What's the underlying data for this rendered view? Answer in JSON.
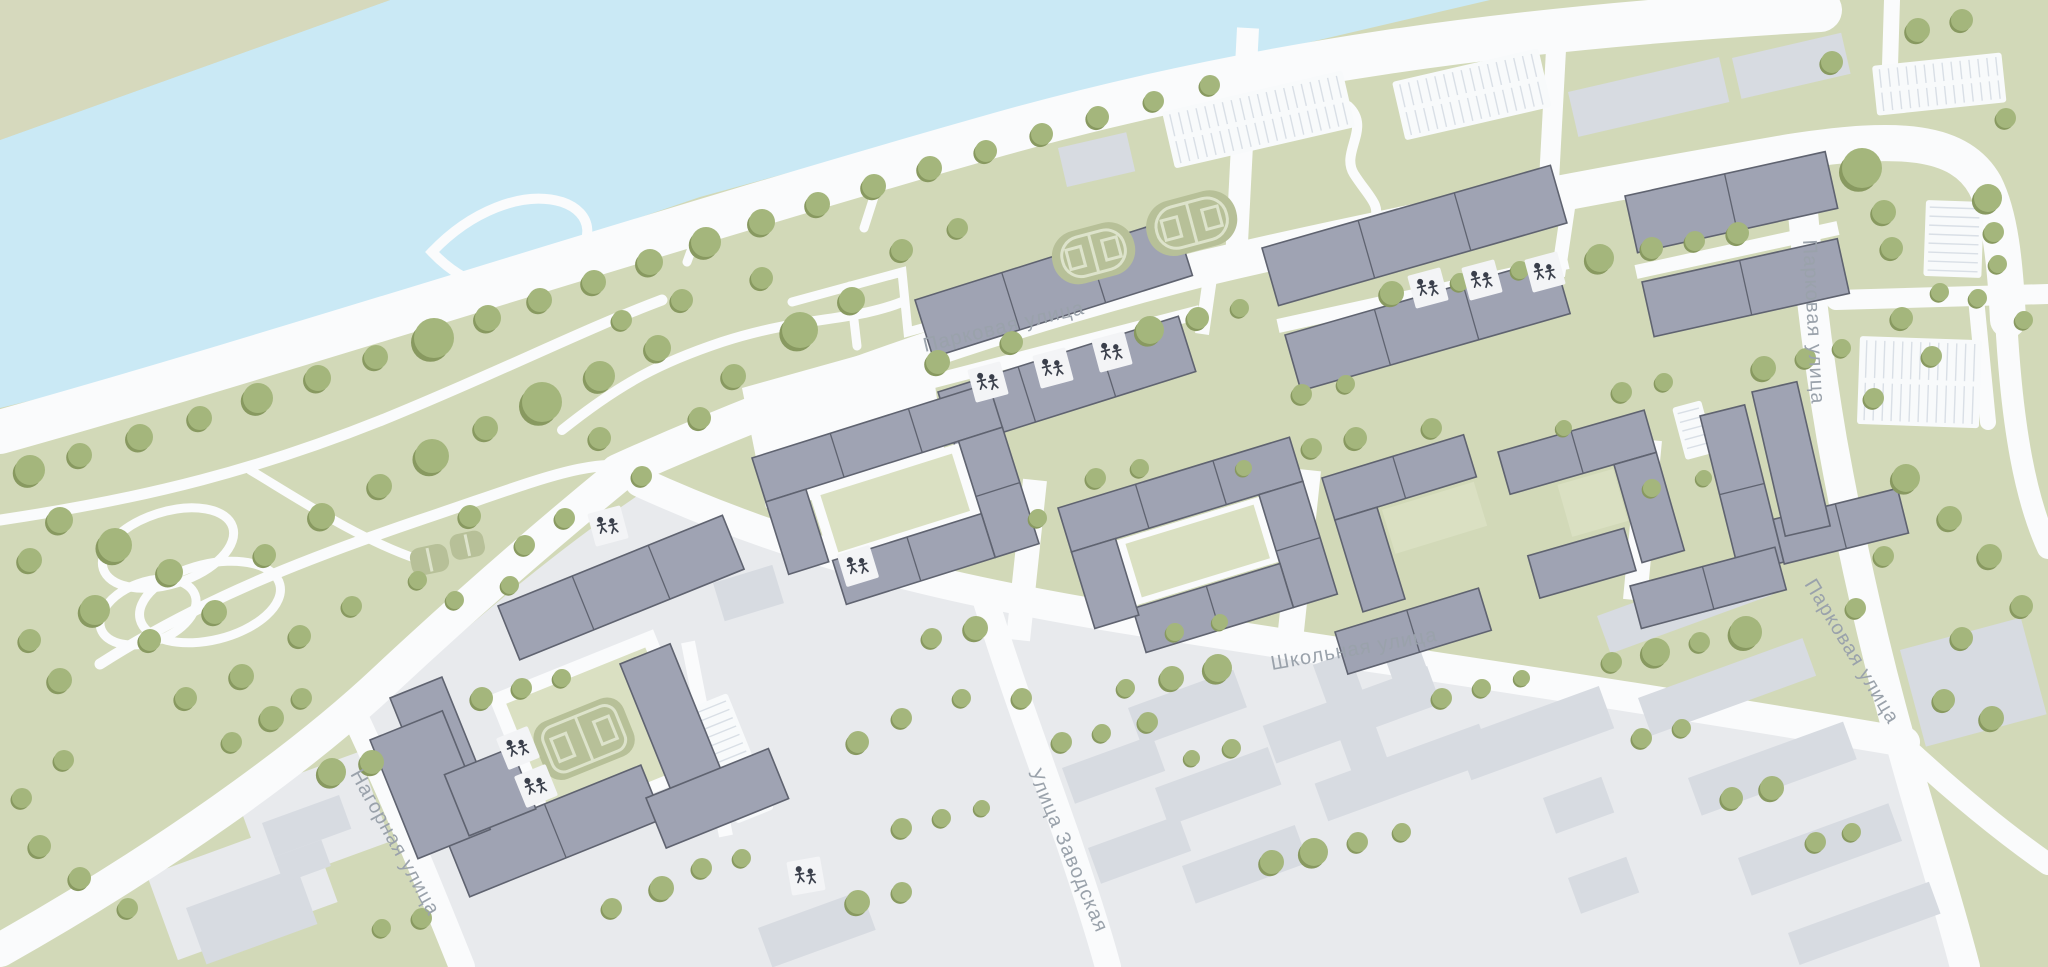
{
  "map": {
    "streets": [
      {
        "id": "parkovaya-top",
        "name": "Парковая улица"
      },
      {
        "id": "parkovaya-right-upper",
        "name": "Парковая улица"
      },
      {
        "id": "parkovaya-right-lower",
        "name": "Парковая улица"
      },
      {
        "id": "shkolnaya",
        "name": "Школьная улица"
      },
      {
        "id": "zavodskaya",
        "name": "Улица Заводская"
      },
      {
        "id": "nagornaya",
        "name": "Нагорная улица"
      }
    ],
    "icons": {
      "playground-icon": "children-figures-tile",
      "tree-icon": "round-tree-canopy",
      "sport-court-icon": "rounded-court-with-markings",
      "parking-icon": "striped-parking-lot"
    }
  },
  "colors": {
    "water": "#cae9f5",
    "bank": "#d6d9bd",
    "park": "#d2d9b8",
    "park2": "#dae0c2",
    "light": "#e8eaed",
    "road": "#fafbfc",
    "bn": "#9fa3b3",
    "bno": "#5f6370",
    "bo": "#d7dbe1",
    "tree": "#a4b67c",
    "treesh": "#889960",
    "court": "#b7c098",
    "courtline": "#dde3cb",
    "tile": "#f3f4f6",
    "ink": "#3a3f4b",
    "parking": "#f8fafb",
    "parkingline": "#d9dfe6",
    "label": "#9aa2ab"
  }
}
